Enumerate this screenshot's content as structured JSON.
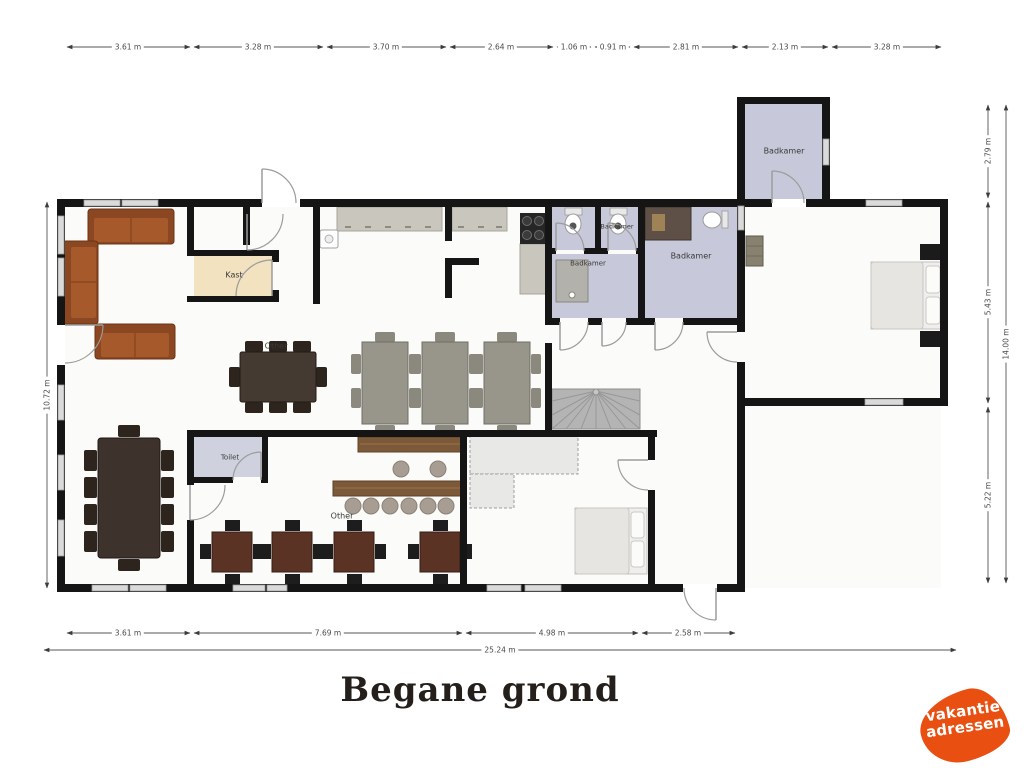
{
  "plan": {
    "title": "Begane grond",
    "rooms": {
      "badkamer_annex": "Badkamer",
      "badkamer_top": "Badkamer",
      "badkamer_shower": "Badkamer",
      "badkamer_main": "Badkamer",
      "kast": "Kast",
      "toilet": "Toilet",
      "other_dining": "Other",
      "other_bar": "Other"
    },
    "dimensions": {
      "top": [
        "3.61 m",
        "3.28 m",
        "3.70 m",
        "2.64 m",
        "1.06 m",
        "0.91 m",
        "2.81 m",
        "2.13 m",
        "3.28 m"
      ],
      "bottom": [
        "3.61 m",
        "7.69 m",
        "4.98 m",
        "2.58 m"
      ],
      "bottom_total": "25.24 m",
      "left": "10.72 m",
      "right": [
        "2.79 m",
        "5.43 m",
        "5.22 m"
      ],
      "right_total": "14.00 m"
    }
  },
  "logo": {
    "line1": "vakantie",
    "line2": "adressen",
    "color": "#e84f11"
  },
  "colors": {
    "wall": "#151515",
    "bathroom_fill": "#c7c9da",
    "kast_fill": "#f2e2c0",
    "accent_orange": "#e84f11"
  }
}
